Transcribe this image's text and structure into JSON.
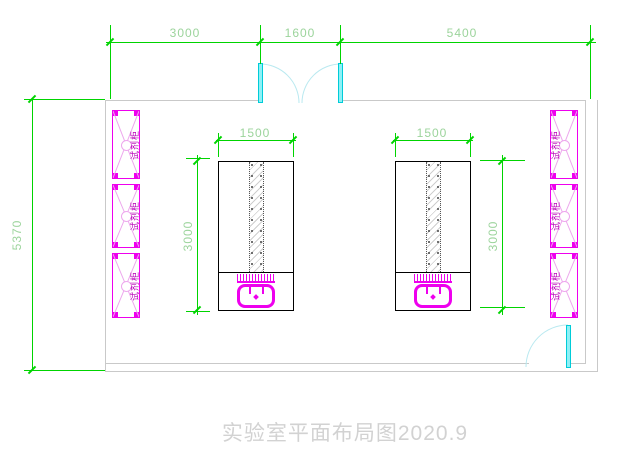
{
  "title": {
    "text": "实验室平面布局图2020.9"
  },
  "dimensions": {
    "top_left": "3000",
    "top_middle": "1600",
    "top_right": "5400",
    "room_height": "5370",
    "bench_left_width": "1500",
    "bench_left_length": "3000",
    "bench_right_width": "1500",
    "bench_right_length": "3000"
  },
  "cabinets": {
    "left": [
      {
        "label": "试剂柜"
      },
      {
        "label": "试剂柜"
      },
      {
        "label": "试剂柜"
      }
    ],
    "right": [
      {
        "label": "试剂柜"
      },
      {
        "label": "试剂柜"
      },
      {
        "label": "试剂柜"
      }
    ]
  },
  "colors": {
    "dimension_line": "#00d400",
    "dimension_text": "#9cd49c",
    "wall": "#c9c9c9",
    "bench_outline": "#000000",
    "cabinet": "#ee00ee",
    "cabinet_hatch": "#eda7ed",
    "cabinet_text": "#b800b8",
    "sink": "#ee00ee",
    "door_fill": "#8ef0f6",
    "door_frame": "#00ccd8",
    "door_arc": "#b9e9f0",
    "title_text": "#d2d2d2"
  }
}
